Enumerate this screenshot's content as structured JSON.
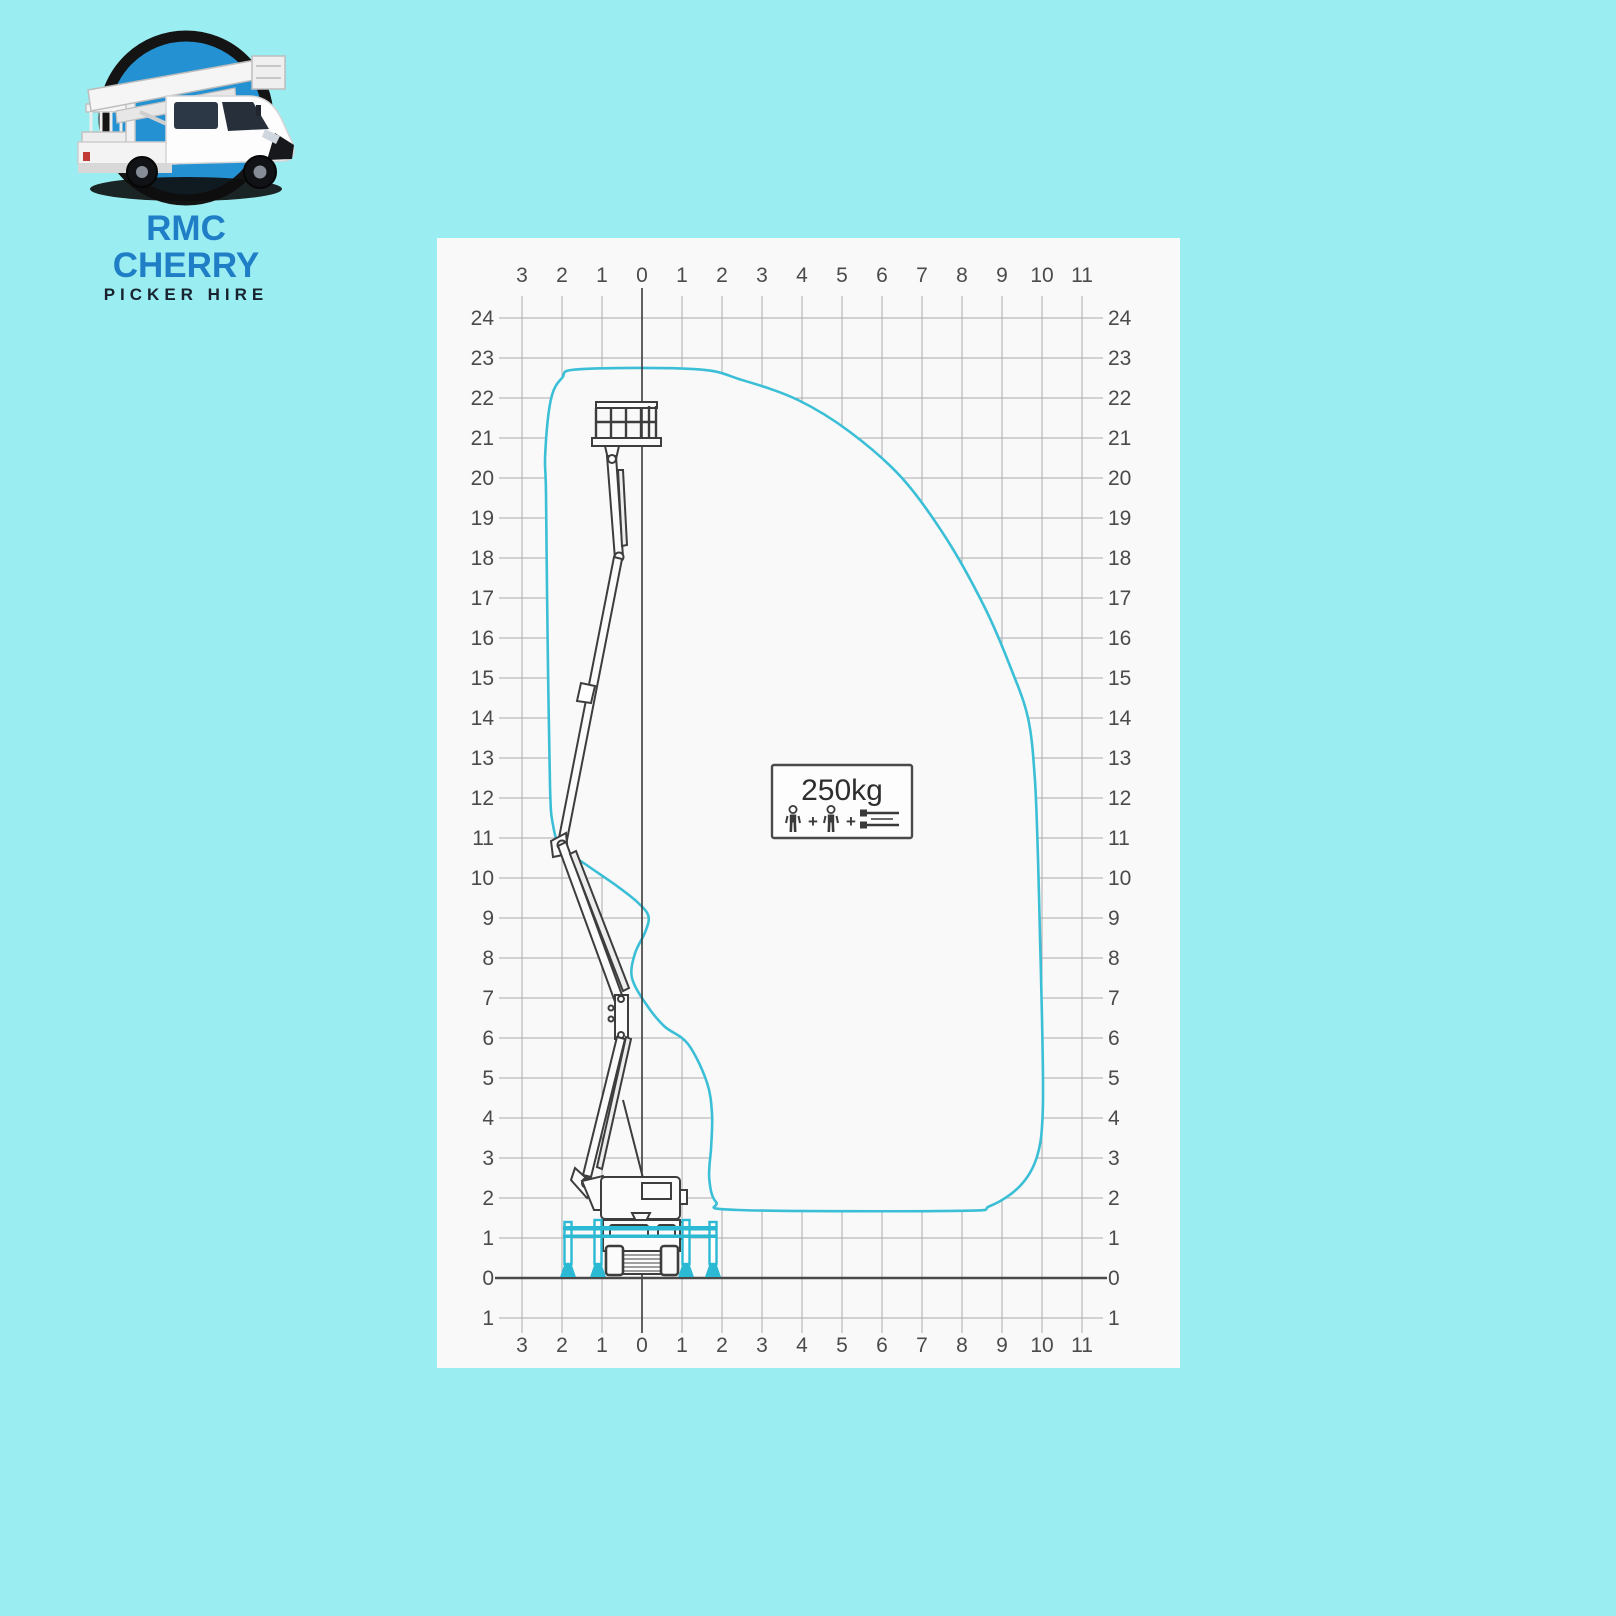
{
  "page": {
    "background_color": "#9aedf1"
  },
  "logo": {
    "line1": "RMC CHERRY",
    "line2": "PICKER HIRE",
    "colors": {
      "line1_text": "#1f7ec6",
      "line2_text": "#18232f",
      "emblem_fill": "#2492d2",
      "emblem_ring": "#141414"
    }
  },
  "chart_data": {
    "type": "area",
    "title": "Cherry picker working envelope (outreach vs height, metres)",
    "x_axis": {
      "range": [
        -3,
        11
      ],
      "tick_labels": [
        "3",
        "2",
        "1",
        "0",
        "1",
        "2",
        "3",
        "4",
        "5",
        "6",
        "7",
        "8",
        "9",
        "10",
        "11"
      ],
      "shown_top_and_bottom": true
    },
    "y_axis": {
      "range": [
        -1,
        24
      ],
      "tick_labels": [
        "24",
        "23",
        "22",
        "21",
        "20",
        "19",
        "18",
        "17",
        "16",
        "15",
        "14",
        "13",
        "12",
        "11",
        "10",
        "9",
        "8",
        "7",
        "6",
        "5",
        "4",
        "3",
        "2",
        "1",
        "0",
        "1"
      ],
      "shown_left_and_right": true
    },
    "grid": true,
    "envelope_color": "#3bbfd6",
    "grid_color": "#ababab",
    "axis_color": "#3a3a3a",
    "max_working_height_m": 22.7,
    "max_outreach_m": 10.0,
    "load_limit": {
      "capacity_label": "250kg",
      "icons": [
        "person-icon",
        "plus",
        "person-icon",
        "plus",
        "tools-icon"
      ]
    },
    "envelope_outline_m": [
      [
        -1.55,
        22.72
      ],
      [
        1.35,
        22.72
      ],
      [
        2.5,
        22.45
      ],
      [
        3.9,
        21.95
      ],
      [
        5.2,
        21.15
      ],
      [
        6.5,
        20.0
      ],
      [
        7.6,
        18.5
      ],
      [
        8.55,
        16.8
      ],
      [
        9.2,
        15.3
      ],
      [
        9.65,
        14.0
      ],
      [
        9.82,
        12.5
      ],
      [
        9.9,
        10.5
      ],
      [
        9.95,
        8.5
      ],
      [
        10.0,
        6.5
      ],
      [
        10.02,
        4.2
      ],
      [
        9.88,
        3.05
      ],
      [
        9.45,
        2.3
      ],
      [
        8.7,
        1.8
      ],
      [
        7.9,
        1.68
      ],
      [
        2.4,
        1.7
      ],
      [
        1.85,
        1.9
      ],
      [
        1.68,
        2.5
      ],
      [
        1.73,
        3.3
      ],
      [
        1.75,
        4.1
      ],
      [
        1.62,
        4.9
      ],
      [
        1.15,
        5.85
      ],
      [
        0.55,
        6.3
      ],
      [
        0.1,
        6.85
      ],
      [
        -0.25,
        7.5
      ],
      [
        -0.18,
        8.1
      ],
      [
        0.08,
        8.65
      ],
      [
        0.16,
        9.05
      ],
      [
        -0.12,
        9.4
      ],
      [
        -0.6,
        9.78
      ],
      [
        -1.35,
        10.3
      ],
      [
        -2.02,
        10.78
      ],
      [
        -2.22,
        11.3
      ],
      [
        -2.3,
        12.3
      ],
      [
        -2.36,
        16.0
      ],
      [
        -2.4,
        19.6
      ],
      [
        -2.42,
        20.6
      ],
      [
        -2.28,
        21.95
      ],
      [
        -2.0,
        22.5
      ]
    ]
  }
}
